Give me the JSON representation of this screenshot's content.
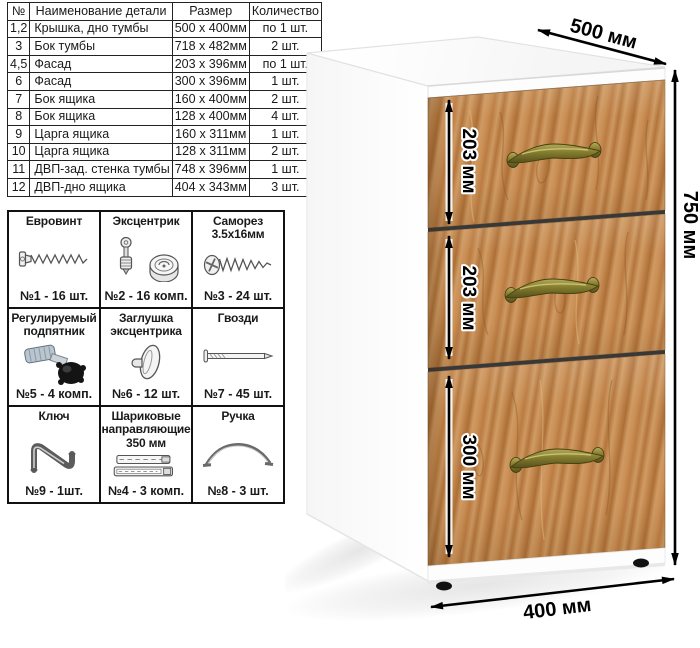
{
  "parts_table": {
    "headers": [
      "№",
      "Наименование детали",
      "Размер",
      "Количество"
    ],
    "rows": [
      {
        "num": "1,2",
        "name": "Крышка, дно тумбы",
        "size": "500 x 400мм",
        "qty": "по 1 шт."
      },
      {
        "num": "3",
        "name": "Бок тумбы",
        "size": "718 x 482мм",
        "qty": "2 шт."
      },
      {
        "num": "4,5",
        "name": "Фасад",
        "size": "203 x 396мм",
        "qty": "по 1 шт."
      },
      {
        "num": "6",
        "name": "Фасад",
        "size": "300 x 396мм",
        "qty": "1 шт."
      },
      {
        "num": "7",
        "name": "Бок ящика",
        "size": "160 x 400мм",
        "qty": "2 шт."
      },
      {
        "num": "8",
        "name": "Бок ящика",
        "size": "128 x 400мм",
        "qty": "4 шт."
      },
      {
        "num": "9",
        "name": "Царга ящика",
        "size": "160 x 311мм",
        "qty": "1 шт."
      },
      {
        "num": "10",
        "name": "Царга ящика",
        "size": "128 x 311мм",
        "qty": "2 шт."
      },
      {
        "num": "11",
        "name": "ДВП-зад. стенка тумбы",
        "size": "748 x 396мм",
        "qty": "1 шт."
      },
      {
        "num": "12",
        "name": "ДВП-дно ящика",
        "size": "404 x 343мм",
        "qty": "3 шт."
      }
    ]
  },
  "hardware": {
    "items": [
      {
        "title": "Евровинт",
        "count": "№1 - 16 шт.",
        "icon": "euro-screw-icon"
      },
      {
        "title": "Эксцентрик",
        "count": "№2 - 16 комп.",
        "icon": "cam-lock-icon"
      },
      {
        "title": "Саморез 3.5х16мм",
        "count": "№3 - 24 шт.",
        "icon": "self-tapping-screw-icon"
      },
      {
        "title": "Регулируемый подпятник",
        "count": "№5 - 4 комп.",
        "icon": "adjustable-foot-icon"
      },
      {
        "title": "Заглушка эксцентрика",
        "count": "№6 - 12 шт.",
        "icon": "cam-cap-icon"
      },
      {
        "title": "Гвозди",
        "count": "№7 - 45 шт.",
        "icon": "nail-icon"
      },
      {
        "title": "Ключ",
        "count": "№9 - 1шт.",
        "icon": "hex-key-icon"
      },
      {
        "title": "Шариковые направляющие 350 мм",
        "count": "№4 - 3 комп.",
        "icon": "ball-slides-icon"
      },
      {
        "title": "Ручка",
        "count": "№8 - 3 шт.",
        "icon": "handle-icon"
      }
    ]
  },
  "diagram": {
    "dimensions": {
      "top_depth": "500 мм",
      "height": "750 мм",
      "width": "400 мм",
      "drawer1_height": "203 мм",
      "drawer2_height": "203 мм",
      "drawer3_height": "300 мм"
    },
    "colors": {
      "body_white": "#ffffff",
      "wood_base": "#c48a50",
      "wood_dark": "#ad6f36",
      "wood_light": "#d09c64",
      "handle_brass": "#837b2e",
      "dimension_lines": "#000000",
      "table_border": "#222222"
    }
  }
}
